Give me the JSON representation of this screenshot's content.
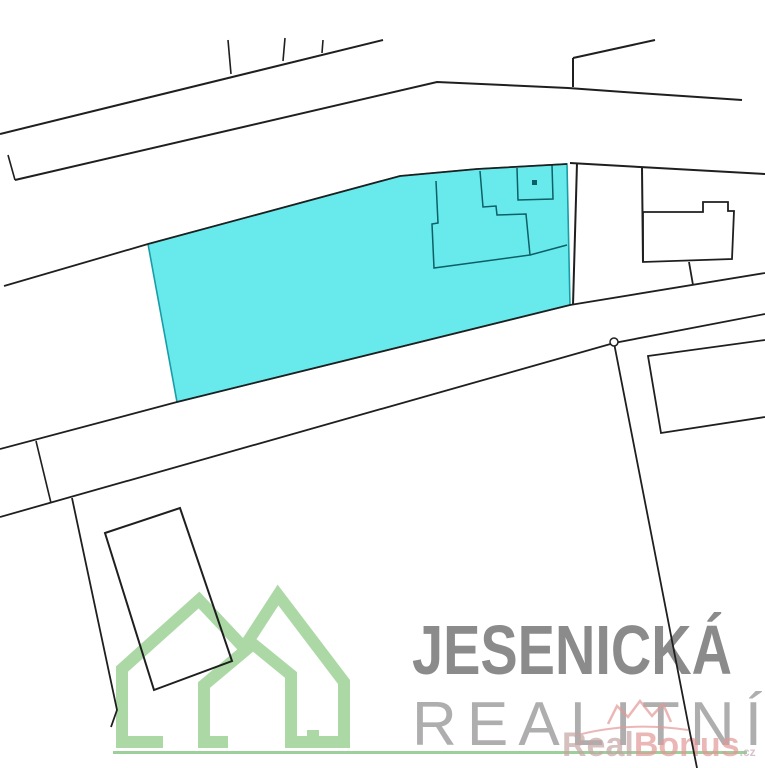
{
  "image": {
    "kind": "cadastral-parcel-map",
    "width": 765,
    "height": 768
  },
  "colors": {
    "boundary": "#1f1f1f",
    "parcelFill": "#68e9ec",
    "parcelStroke": "#189da6",
    "innerLine": "#0b5f66",
    "logoGreen": "#acd8a6",
    "logoBaseline": "#9ccf99",
    "titleGray": "#8b8b8b",
    "subtitleGray": "#aeaeae",
    "brandMuted": "#c4a4a4",
    "brandPink": "#e39898",
    "brandSuffix": "#c2aab2",
    "pointFill": "#ffffff"
  },
  "watermark": {
    "line1": "JESENICKÁ",
    "line2": "REALITNÍ"
  },
  "brand": {
    "part1": "Real",
    "part2": "Bonus",
    "suffix": ".cz",
    "crown_path": "M608,724 L617,706 L628,717 L640,701 L652,716 L663,704 L671,722",
    "swoosh_path": "M574,736 Q628,721 688,730"
  },
  "logo": {
    "features": [
      {
        "name": "logo-house-left",
        "type": "path",
        "d": "M163,742 H122 V669 L199,600 L247,651",
        "stroke": "logoGreen",
        "sw": 12,
        "fill": "none"
      },
      {
        "name": "logo-house-right",
        "type": "path",
        "d": "M243,649 L278,595 L344,682 V742 H313 V730",
        "stroke": "logoGreen",
        "sw": 12,
        "fill": "none"
      },
      {
        "name": "logo-house-inner",
        "type": "path",
        "d": "M228,742 H204 V685 L253,644 L291,675 V742 H344",
        "stroke": "logoGreen",
        "sw": 12,
        "fill": "none"
      },
      {
        "name": "logo-baseline",
        "type": "rect",
        "x": 113,
        "y": 751,
        "wd": 634,
        "ht": 3,
        "fill": "logoBaseline"
      }
    ]
  },
  "map": {
    "features": [
      {
        "name": "highlighted-parcel",
        "type": "polygon",
        "points": "148,244 400,176 477,169 567,164 570,305 177,402",
        "stroke": "parcelStroke",
        "sw": 1.6,
        "fill": "parcelFill"
      },
      {
        "name": "parcel-inner-building-outline",
        "type": "polyline",
        "points": "436,181 438,223 432,224 434,268 530,255 526,214 497,215 496,206 483,207 480,171",
        "stroke": "innerLine",
        "sw": 1.5,
        "fill": "none"
      },
      {
        "name": "parcel-inner-divider",
        "type": "polyline",
        "points": "530,255 567,245",
        "stroke": "innerLine",
        "sw": 1.5,
        "fill": "none"
      },
      {
        "name": "parcel-inner-subplot",
        "type": "polyline",
        "points": "517,168 518,200 553,199 552,165",
        "stroke": "innerLine",
        "sw": 1.5,
        "fill": "none"
      },
      {
        "name": "parcel-point-marker",
        "type": "rect",
        "x": 532,
        "y": 180,
        "wd": 5,
        "ht": 5,
        "fill": "innerLine"
      },
      {
        "name": "road-north-upper-edge",
        "type": "polyline",
        "points": "0,134 383,40",
        "stroke": "boundary",
        "sw": 2,
        "fill": "none"
      },
      {
        "name": "boundary-stub-1",
        "type": "polyline",
        "points": "228,40 231,74",
        "stroke": "boundary",
        "sw": 1.6,
        "fill": "none"
      },
      {
        "name": "boundary-stub-2",
        "type": "polyline",
        "points": "285,38 283,61",
        "stroke": "boundary",
        "sw": 1.6,
        "fill": "none"
      },
      {
        "name": "boundary-stub-3",
        "type": "polyline",
        "points": "323,40 322,53",
        "stroke": "boundary",
        "sw": 1.6,
        "fill": "none"
      },
      {
        "name": "road-north-lower-edge",
        "type": "polyline",
        "points": "15,180 437,82 568,88 638,93 742,100",
        "stroke": "boundary",
        "sw": 2,
        "fill": "none"
      },
      {
        "name": "edge-tick-west",
        "type": "polyline",
        "points": "8,155 15,180",
        "stroke": "boundary",
        "sw": 1.6,
        "fill": "none"
      },
      {
        "name": "branch-vertical-ne",
        "type": "polyline",
        "points": "573,87 573,58",
        "stroke": "boundary",
        "sw": 2,
        "fill": "none"
      },
      {
        "name": "branch-diagonal-ne",
        "type": "polyline",
        "points": "573,58 655,40",
        "stroke": "boundary",
        "sw": 2,
        "fill": "none"
      },
      {
        "name": "boundary-west-mid",
        "type": "polyline",
        "points": "4,286 148,244",
        "stroke": "boundary",
        "sw": 1.8,
        "fill": "none"
      },
      {
        "name": "parcel-north-boundary",
        "type": "polyline",
        "points": "148,244 400,176 477,169 567,164",
        "stroke": "boundary",
        "sw": 1.8,
        "fill": "none"
      },
      {
        "name": "road-mid-upper-edge",
        "type": "polyline",
        "points": "0,449 177,402 570,305 765,273",
        "stroke": "boundary",
        "sw": 1.8,
        "fill": "none"
      },
      {
        "name": "road-mid-lower-edge",
        "type": "polyline",
        "points": "0,517 614,343 765,314",
        "stroke": "boundary",
        "sw": 1.8,
        "fill": "none"
      },
      {
        "name": "cross-tick-west",
        "type": "polyline",
        "points": "36,441 51,503",
        "stroke": "boundary",
        "sw": 1.6,
        "fill": "none"
      },
      {
        "name": "boundary-southwest",
        "type": "polyline",
        "points": "72,498 117,710 111,727",
        "stroke": "boundary",
        "sw": 1.8,
        "fill": "none"
      },
      {
        "name": "boundary-south-steep",
        "type": "polyline",
        "points": "614,343 653,543 688,723 697,768",
        "stroke": "boundary",
        "sw": 1.8,
        "fill": "none"
      },
      {
        "name": "boundary-east-of-parcel",
        "type": "polyline",
        "points": "577,163 573,305",
        "stroke": "boundary",
        "sw": 2,
        "fill": "none"
      },
      {
        "name": "road-east-upper-edge",
        "type": "polyline",
        "points": "570,163 640,167 765,174",
        "stroke": "boundary",
        "sw": 2,
        "fill": "none"
      },
      {
        "name": "boundary-east-2",
        "type": "polyline",
        "points": "642,168 643,262",
        "stroke": "boundary",
        "sw": 2,
        "fill": "none"
      },
      {
        "name": "building-east-outline",
        "type": "polygon",
        "points": "643,212 703,212 703,202 728,202 728,211 734,211 732,259 643,262",
        "stroke": "boundary",
        "sw": 1.8,
        "fill": "none"
      },
      {
        "name": "building-east-stem",
        "type": "polyline",
        "points": "689,262 693,285",
        "stroke": "boundary",
        "sw": 1.8,
        "fill": "none"
      },
      {
        "name": "parcel-southeast-outline",
        "type": "polyline",
        "points": "765,340 648,356 661,433 765,417",
        "stroke": "boundary",
        "sw": 1.8,
        "fill": "none"
      },
      {
        "name": "parcel-southwest-outline",
        "type": "polygon",
        "points": "105,533 180,508 232,661 154,690",
        "stroke": "boundary",
        "sw": 2,
        "fill": "none"
      },
      {
        "name": "survey-point-circle",
        "type": "circle",
        "cx": 614,
        "cy": 342,
        "r": 4,
        "stroke": "boundary",
        "sw": 1.5,
        "fill": "pointFill"
      }
    ]
  }
}
